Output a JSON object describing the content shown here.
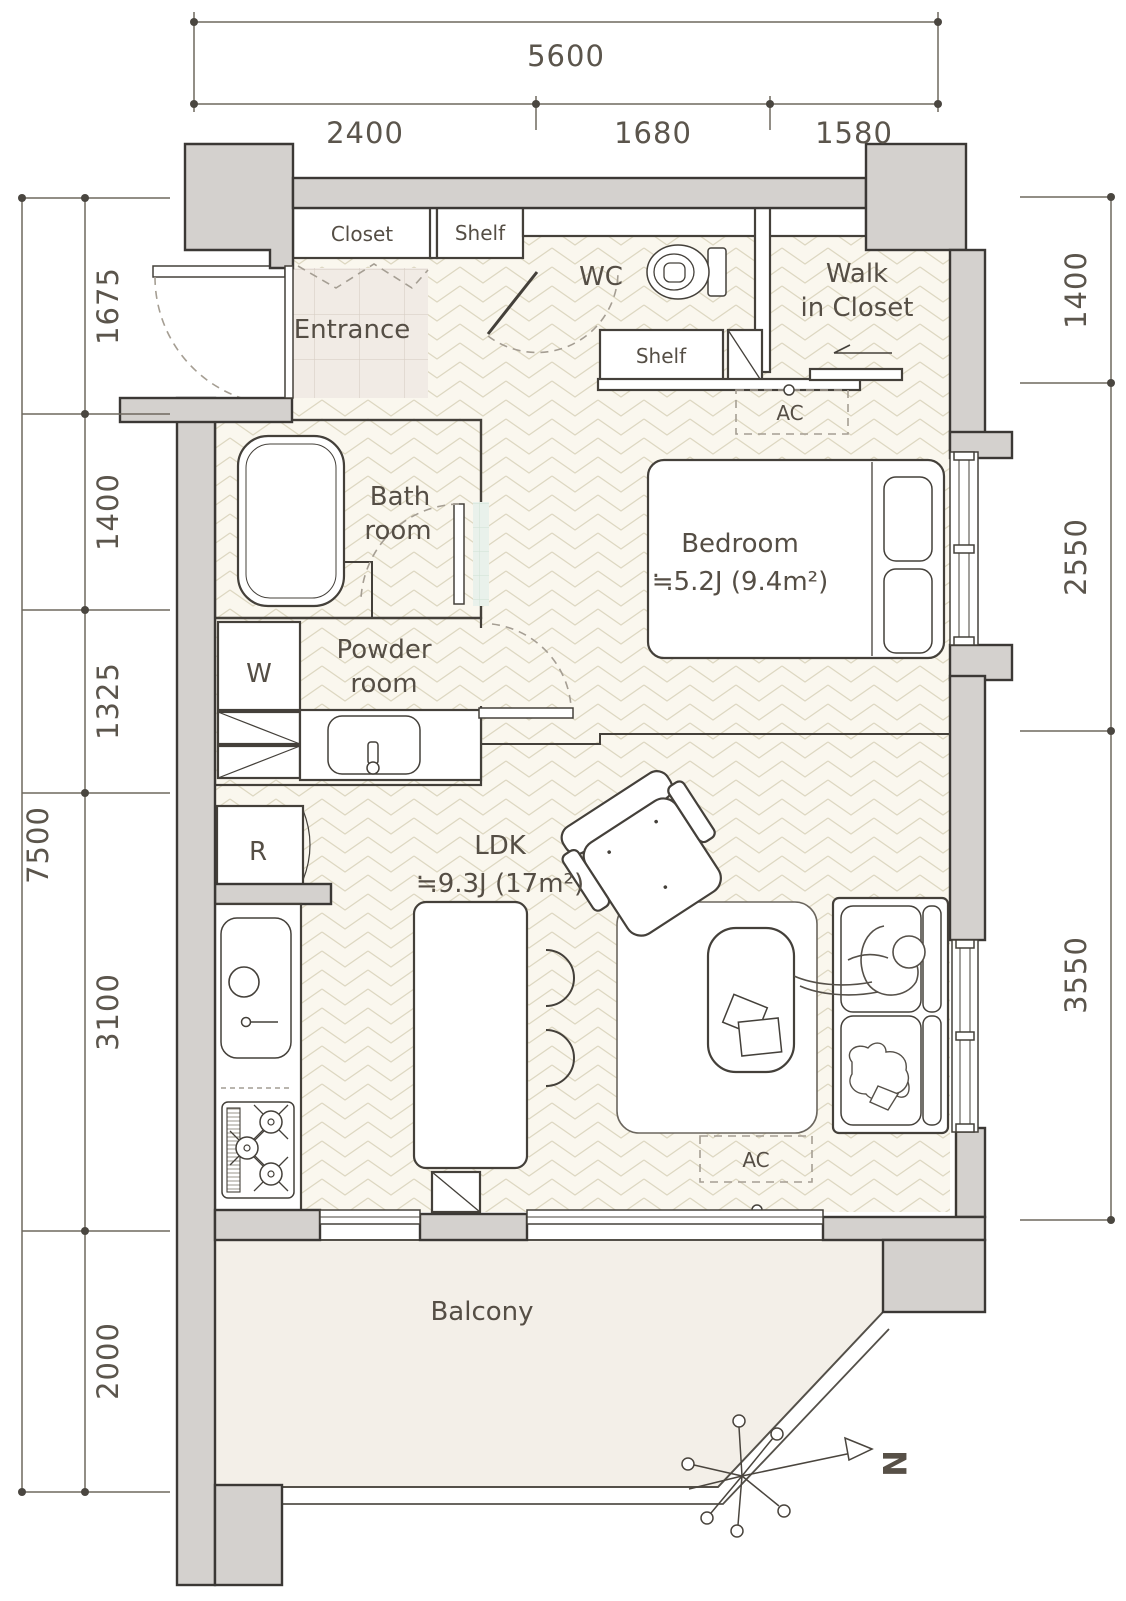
{
  "title": "apartment-floor-plan",
  "colors": {
    "wall_fill": "#d4d1ce",
    "wall_stroke": "#3b3835",
    "floor_herringbone": "#faf7ee",
    "floor_pattern_line": "#ddd7c1",
    "entrance_tile": "#f1ebe5",
    "bath_tile": "#e9f1eb",
    "powder_tile": "#f3ede9",
    "balcony_fill": "#f3efe8",
    "dim_line": "#6e695f",
    "text": "#554e45"
  },
  "dims": {
    "top": {
      "total": "5600",
      "seg1": "2400",
      "seg2": "1680",
      "seg3": "1580"
    },
    "left": {
      "total": "7500",
      "seg1": "1675",
      "seg2": "1400",
      "seg3": "1325",
      "seg4": "3100",
      "seg5": "2000"
    },
    "right": {
      "seg1": "1400",
      "seg2": "2550",
      "seg3": "3550"
    }
  },
  "labels": {
    "closet": "Closet",
    "shelf_top": "Shelf",
    "wc": "WC",
    "wic_line1": "Walk",
    "wic_line2": "in Closet",
    "entrance": "Entrance",
    "ac_top": "AC",
    "bedroom": "Bedroom",
    "bedroom_size": "≒5.2J (9.4m²)",
    "bath_line1": "Bath",
    "bath_line2": "room",
    "powder_line1": "Powder",
    "powder_line2": "room",
    "washer": "W",
    "shelf_wc": "Shelf",
    "fridge": "R",
    "ldk": "LDK",
    "ldk_size": "≒9.3J (17m²)",
    "ac_bottom": "AC",
    "balcony": "Balcony",
    "north": "N"
  }
}
